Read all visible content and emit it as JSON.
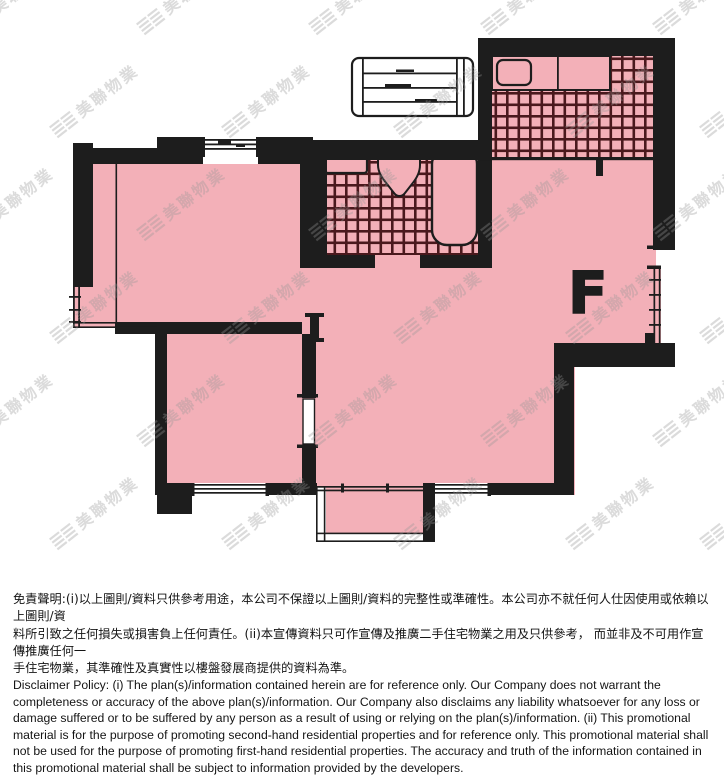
{
  "page": {
    "background": "#ffffff"
  },
  "floor_plan": {
    "unit_label": "F",
    "colors": {
      "room_fill": "#f3b0b8",
      "wall": "#1d1d1d",
      "tile_line": "#4a191d",
      "watermark": "#979797",
      "background": "#ffffff"
    }
  },
  "watermark": {
    "glyph": "≣≣",
    "text": "美聯物業"
  },
  "disclaimer": {
    "zh_lines": [
      "免責聲明:(i)以上圖則/資料只供參考用途，本公司不保證以上圖則/資料的完整性或準確性。本公司亦不就任何人仕因使用或依賴以上圖則/資",
      "料所引致之任何損失或損害負上任何責任。(ii)本宣傳資料只可作宣傳及推廣二手住宅物業之用及只供參考， 而並非及不可用作宣傳推廣任何一",
      "手住宅物業，其準確性及真實性以樓盤發展商提供的資料為準。"
    ],
    "en_lines": [
      "Disclaimer Policy: (i) The plan(s)/information contained herein are for reference only. Our Company does not warrant the",
      "completeness or accuracy of the above plan(s)/information. Our Company also disclaims any liability whatsoever for any loss or",
      "damage suffered or to be suffered by any person as a result of using or relying on the plan(s)/information. (ii) This promotional",
      "material is for the purpose of promoting second-hand residential properties and for reference only. This promotional material shall",
      "not be used for the purpose of promoting first-hand residential properties. The accuracy and truth of the information contained in",
      "this promotional material shall be subject to information provided by the developers."
    ]
  }
}
